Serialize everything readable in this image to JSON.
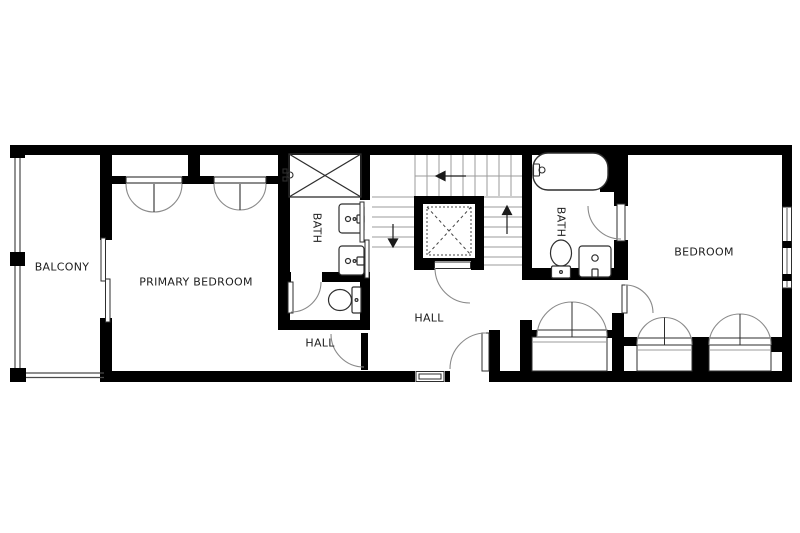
{
  "floorplan": {
    "title": "Upper floor plan",
    "rooms": {
      "balcony": "BALCONY",
      "primary_bedroom": "PRIMARY BEDROOM",
      "bath_left": "BATH",
      "hall_lower": "HALL",
      "hall_center": "HALL",
      "bath_right": "BATH",
      "bedroom": "BEDROOM"
    },
    "colors": {
      "wall": "#000000",
      "background": "#ffffff",
      "fixture_line": "#2e2e2e",
      "swing_line": "#8a8a8a",
      "stair_line": "#9b9b9b"
    }
  }
}
